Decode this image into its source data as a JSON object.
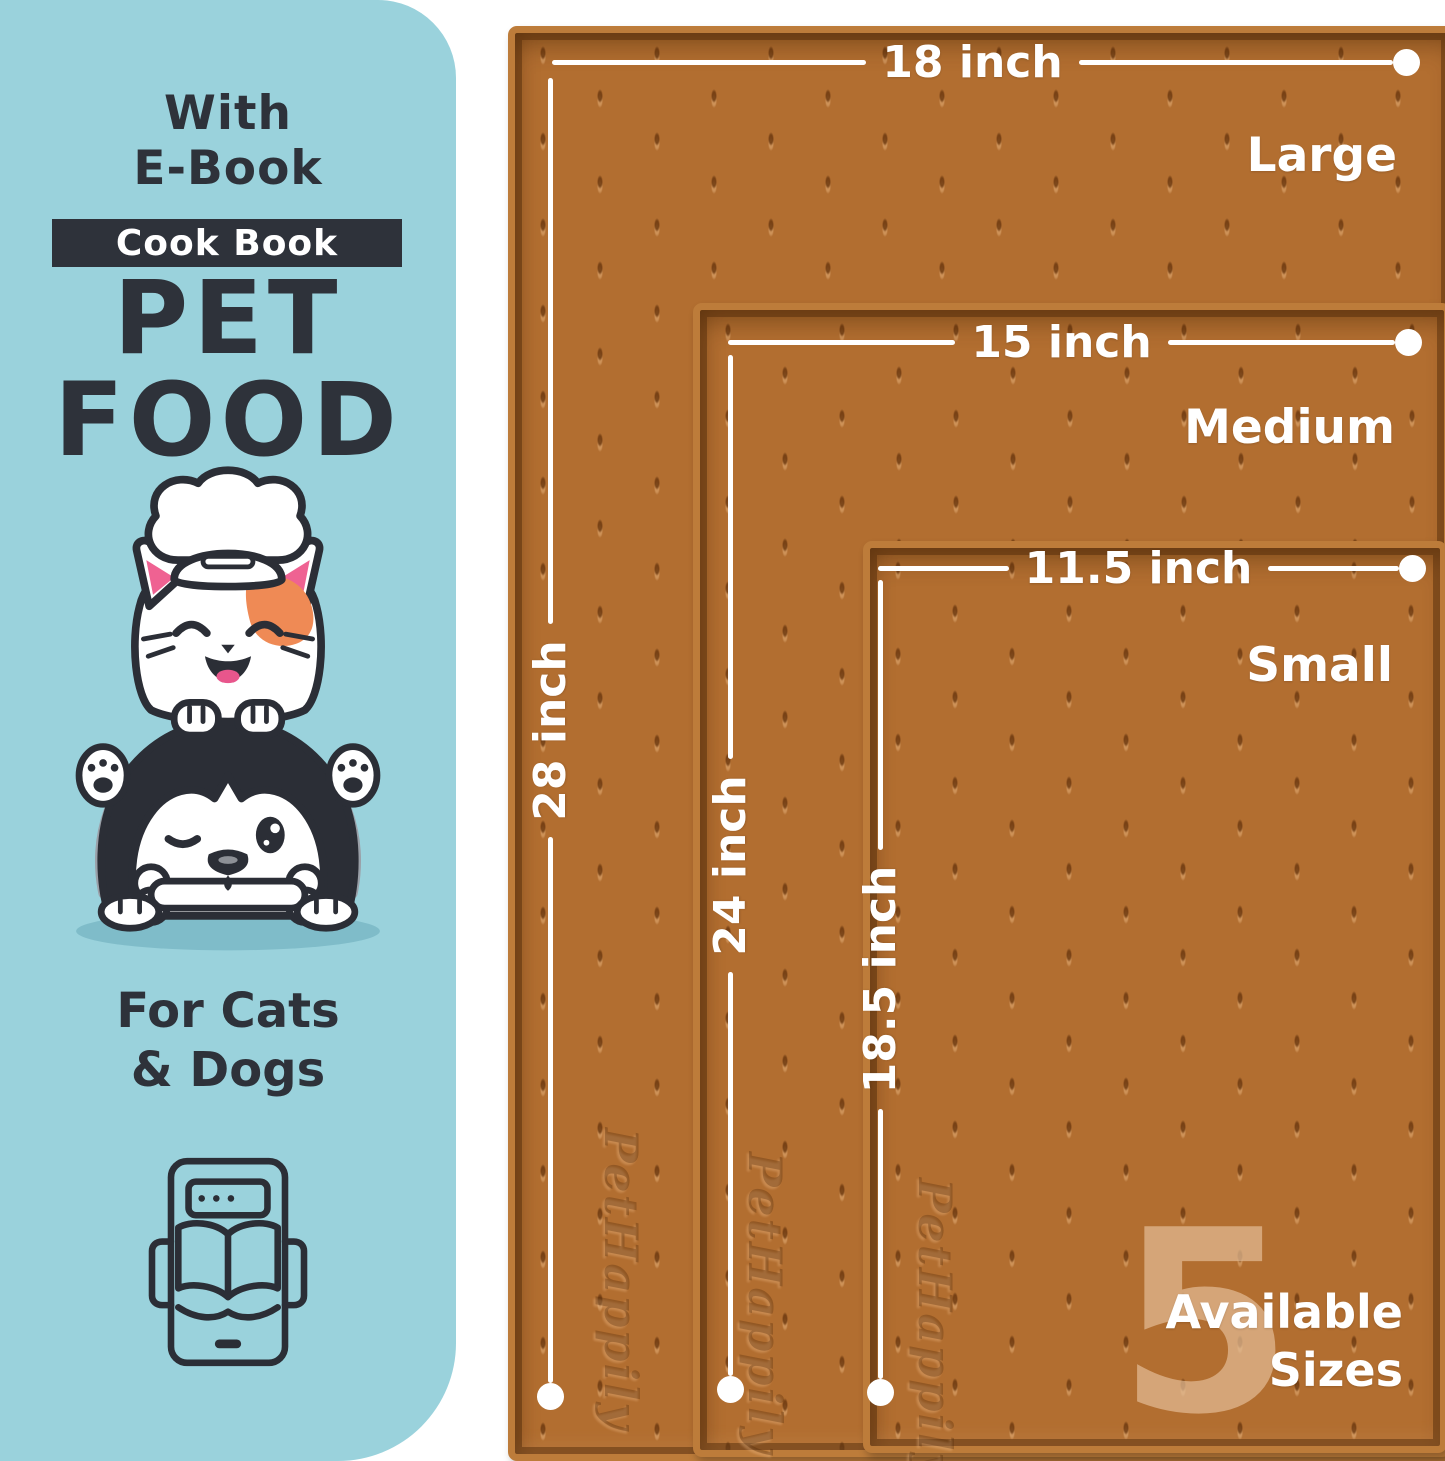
{
  "left_panel": {
    "headline": {
      "line1": "With",
      "line2": "E-Book"
    },
    "badge": "Cook Book",
    "title": {
      "line1": "PET",
      "line2": "FOOD"
    },
    "audience": {
      "line1": "For Cats",
      "line2": "& Dogs"
    }
  },
  "mats": [
    {
      "size_name": "Large",
      "width_label": "18 inch",
      "height_label": "28 inch",
      "brand_emboss": "PetHappily"
    },
    {
      "size_name": "Medium",
      "width_label": "15 inch",
      "height_label": "24 inch",
      "brand_emboss": "PetHappily"
    },
    {
      "size_name": "Small",
      "width_label": "11.5 inch",
      "height_label": "18.5 inch",
      "brand_emboss": "PetHappily"
    }
  ],
  "sizes_badge": {
    "number": "5",
    "line1": "Available",
    "line2": "Sizes"
  },
  "colors": {
    "panel_blue": "#9ad2dc",
    "ink": "#2e323a",
    "mat_brown": "#b26e30",
    "mat_rim": "#bd7c3a",
    "dimension_white": "#ffffff",
    "patch_orange": "#ef8a55",
    "inner_ear_pink": "#ef6292",
    "translucent_tan": "rgba(226,187,148,0.72)"
  }
}
